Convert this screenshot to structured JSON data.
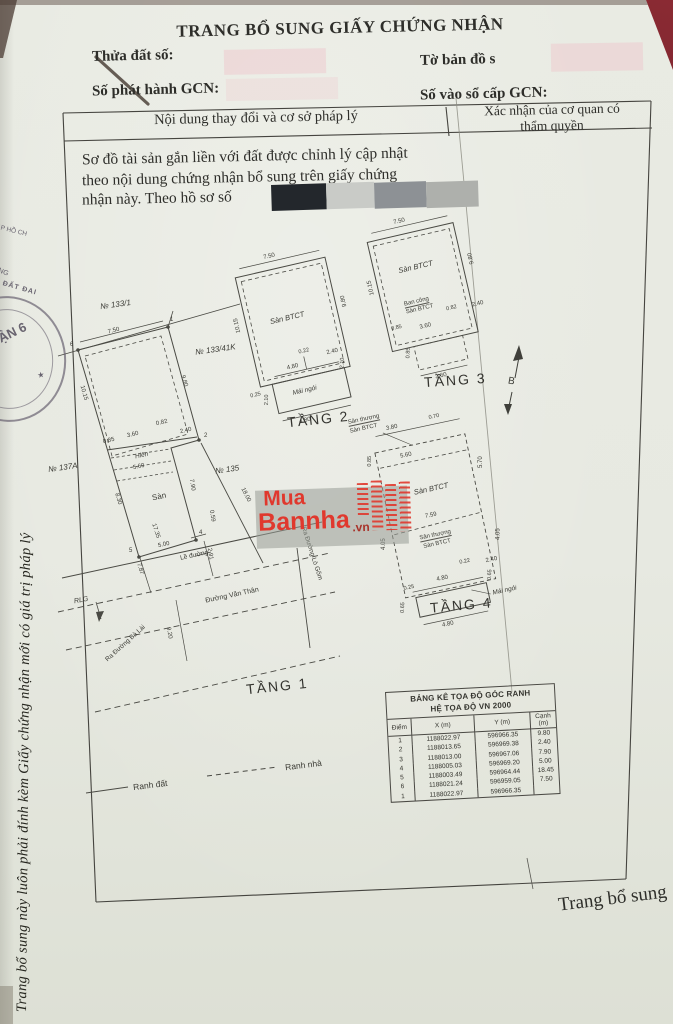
{
  "doc": {
    "title": "TRANG BỔ SUNG GIẤY CHỨNG NHẬN",
    "fields": {
      "thua_dat": "Thửa đất số:",
      "to_ban_do": "Tờ bản đồ s",
      "so_phat_hanh": "Số phát hành GCN:",
      "so_vao_so": "Số vào sổ cấp GCN:"
    },
    "table_header": {
      "left": "Nội dung thay đổi và cơ sở pháp lý",
      "right1": "Xác nhận của cơ quan có",
      "right2": "thẩm quyền"
    },
    "paragraph": {
      "l1": "Sơ đồ tài sản gắn liền với đất được chỉnh lý cập nhật",
      "l2": "theo nội dung chứng nhận bổ sung trên giấy chứng",
      "l3": "nhận này. Theo hồ sơ số"
    },
    "plans": {
      "t1": {
        "title": "TẦNG 1",
        "n1331": "№ 133/1",
        "n13341k": "№ 133/41K",
        "n137a": "№ 137A",
        "n135": "№ 135",
        "hien": "Hiên",
        "san": "Sàn",
        "d750": "7.50",
        "d1015": "10.15",
        "d980": "9.80",
        "d085": "0.85",
        "d360": "3.60",
        "d082": "0.82",
        "d240": "2.40",
        "d560": "5.60",
        "d830": "8.30",
        "d790": "7.90",
        "d059": "0.59",
        "d1735": "17.35",
        "d500": "5.00",
        "d291": "2.91",
        "d787": "7.87",
        "d920": "9.20",
        "d1800": "18.00",
        "v1": "1",
        "v2": "2",
        "v4": "4",
        "v5": "5",
        "v6": "6",
        "rlg": "RLG",
        "le_duong": "Lề đường",
        "duong": "Đường Văn Thân",
        "ra1": "Ra Đường Bà Lài",
        "ra2": "Ra Đường Lò Gốm"
      },
      "t2": {
        "title": "TẦNG 2",
        "san": "Sàn BTCT",
        "mai": "Mái ngói",
        "d750": "7.50",
        "d1015": "10.15",
        "d980": "9.80",
        "d022": "0.22",
        "d240": "2.40",
        "d480a": "4.80",
        "d480b": "4.80",
        "d210a": "2.10",
        "d210b": "2.10",
        "d025": "0.25"
      },
      "t3": {
        "title": "TẦNG 3",
        "san": "Sàn BTCT",
        "bancong1": "Ban công",
        "bancong2": "Sàn BTCT",
        "d750": "7.50",
        "d1015": "10.15",
        "d980": "9.80",
        "d085a": "0.85",
        "d360a": "3.60",
        "d082": "0.82",
        "d240": "2.40",
        "d360b": "3.60",
        "d085b": "0.85"
      },
      "t4": {
        "title": "TẦNG 4",
        "sthuong1a": "Sân thượng",
        "sthuong1b": "Sàn BTCT",
        "san": "Sàn BTCT",
        "sthuong2a": "Sân thượng",
        "sthuong2b": "Sàn BTCT",
        "mai": "Mái ngói",
        "d070": "0.70",
        "d380": "3.80",
        "d560": "5.60",
        "d085": "0.85",
        "d570": "5.70",
        "d759": "7.59",
        "d405a": "4.05",
        "d405b": "4.05",
        "d022": "0.22",
        "d240": "2.40",
        "d025": "0.25",
        "d480a": "4.80",
        "d480b": "4.80",
        "d065a": "0.65",
        "d065b": "0.65"
      }
    },
    "north": {
      "label": "B"
    },
    "legend": {
      "solid": "Ranh đất",
      "dashed": "Ranh nhà"
    },
    "watermark": {
      "l1": "Mua",
      "l2": "Bannha",
      "suffix": ".vn"
    },
    "coord": {
      "title1": "BẢNG KÊ TỌA ĐỘ GÓC RANH",
      "title2": "HỆ TỌA ĐỘ VN 2000",
      "h": [
        "Điểm",
        "X (m)",
        "Y (m)",
        "Cạnh (m)"
      ],
      "rows": [
        [
          "1",
          "1188022.97",
          "596966.35",
          "9.80"
        ],
        [
          "2",
          "1188013.65",
          "596969.38",
          "2.40"
        ],
        [
          "3",
          "1188013.00",
          "596967.06",
          "7.90"
        ],
        [
          "4",
          "1188005.03",
          "596969.20",
          "5.00"
        ],
        [
          "5",
          "1188003.49",
          "596964.44",
          "18.45"
        ],
        [
          "6",
          "1188021.24",
          "596959.05",
          "7.50"
        ],
        [
          "1",
          "1188022.97",
          "596966.35",
          ""
        ]
      ]
    },
    "side_text": "Trang bổ sung này luôn phải đính kèm Giấy chứng nhận mới có giá trị pháp lý",
    "footer": "Trang bổ sung",
    "stamp": {
      "arc_top": "ẠI T.P HỒ CH",
      "f1": "NH",
      "f2": "ONG",
      "f3": "ĐẤT ĐAI",
      "center": "ẬN 6",
      "star": "★"
    }
  }
}
